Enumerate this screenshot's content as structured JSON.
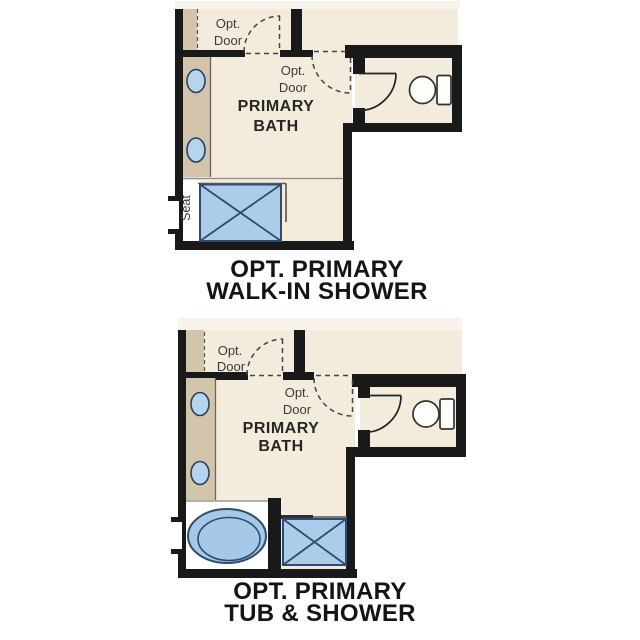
{
  "title": "Primary bath floor plan options",
  "colors": {
    "background": "#ffffff",
    "floor": "#f3ecdd",
    "floor_beyond": "#f8f3ea",
    "wall": "#191919",
    "cabinet_tan": "#d2c5ab",
    "fixture_blue": "#adcce9",
    "fixture_outline": "#2e4d6e",
    "caption_text": "#141414"
  },
  "plans": [
    {
      "name": "opt-primary-walk-in-shower",
      "caption": [
        "OPT. PRIMARY",
        "WALK-IN SHOWER"
      ],
      "room_label": [
        "PRIMARY",
        "BATH"
      ],
      "opt_door_labels": [
        [
          "Opt.",
          "Door"
        ],
        [
          "Opt.",
          "Door"
        ]
      ],
      "seat_label": "Seat",
      "fixtures": [
        "double-sink-vanity",
        "walk-in-shower-with-seat",
        "toilet",
        "window"
      ]
    },
    {
      "name": "opt-primary-tub-and-shower",
      "caption": [
        "OPT. PRIMARY",
        "TUB & SHOWER"
      ],
      "room_label": [
        "PRIMARY",
        "BATH"
      ],
      "opt_door_labels": [
        [
          "Opt.",
          "Door"
        ],
        [
          "Opt.",
          "Door"
        ]
      ],
      "fixtures": [
        "double-sink-vanity",
        "tub",
        "shower",
        "toilet",
        "window"
      ]
    }
  ]
}
